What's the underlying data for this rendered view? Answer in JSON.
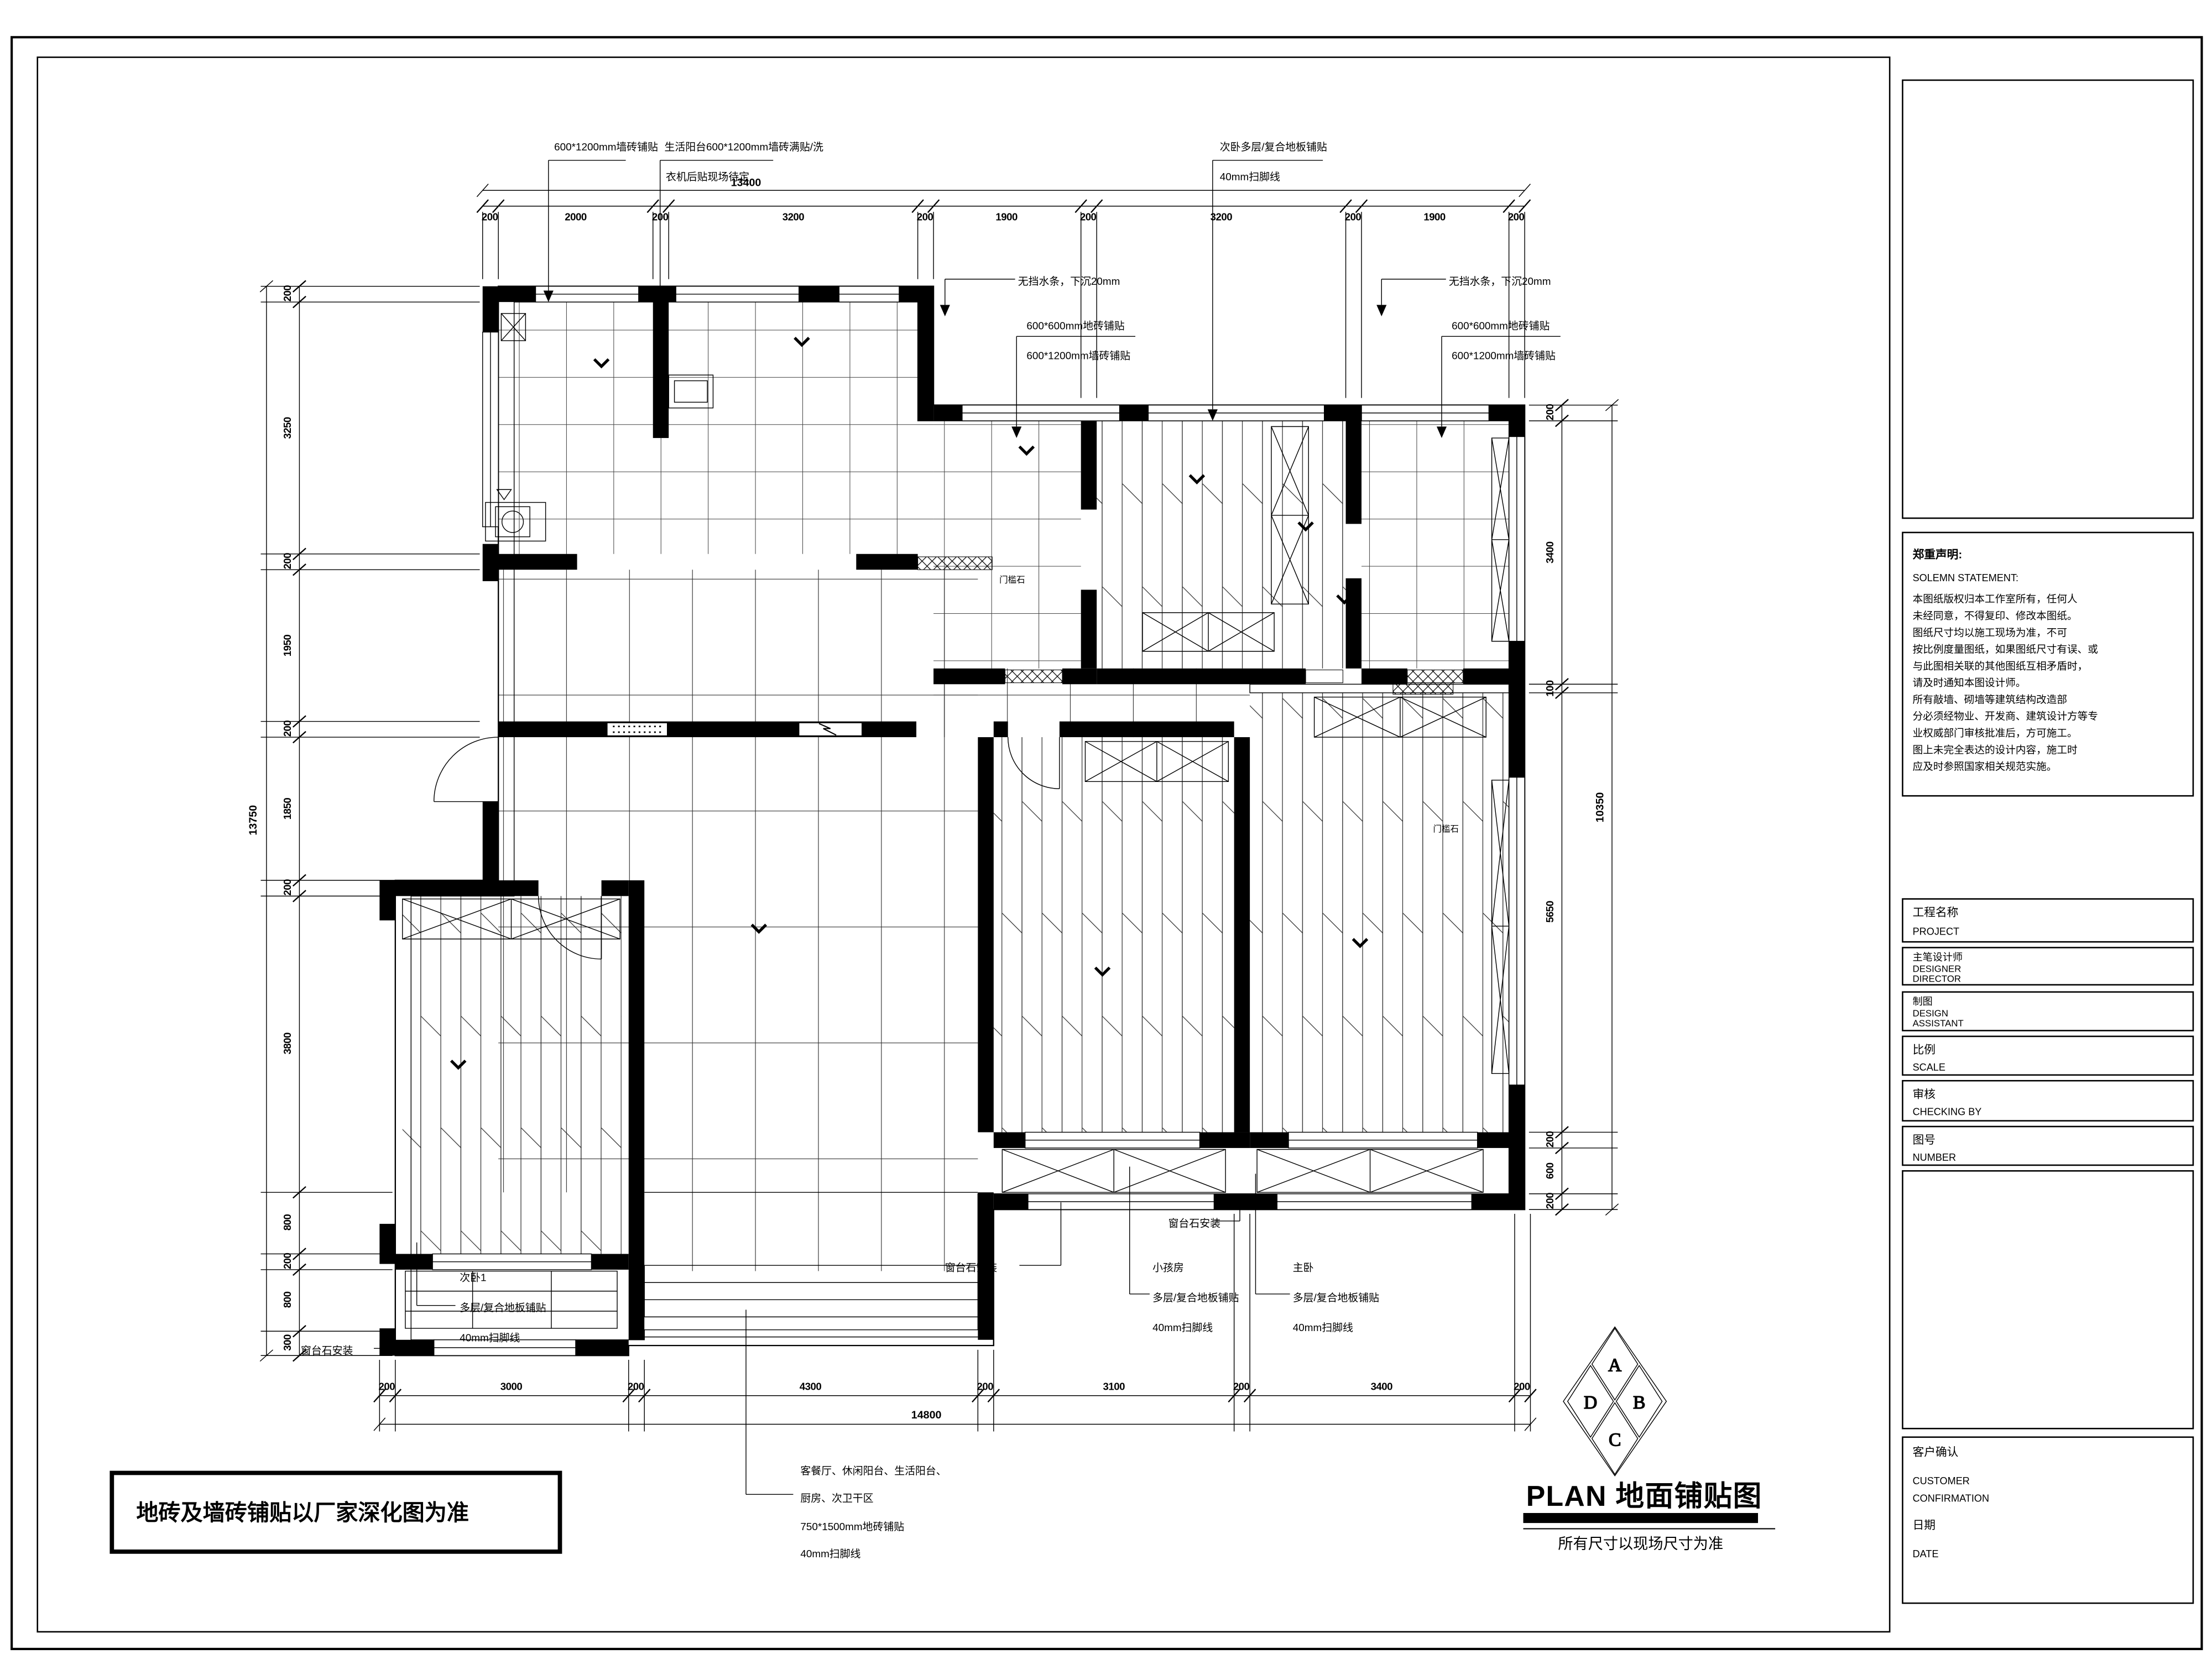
{
  "plan_title": {
    "main": "PLAN 地面铺贴图",
    "subtitle": "所有尺寸以现场尺寸为准"
  },
  "compass": {
    "a": "A",
    "b": "B",
    "c": "C",
    "d": "D"
  },
  "statement": {
    "title_zh": "郑重声明:",
    "title_en": "SOLEMN STATEMENT:",
    "lines": [
      "    本图纸版权归本工作室所有，任何人",
      "未经同意，不得复印、修改本图纸。",
      "    图纸尺寸均以施工现场为准，不可",
      "按比例度量图纸，如果图纸尺寸有误、或",
      "与此图相关联的其他图纸互相矛盾时，",
      "请及时通知本图设计师。",
      "    所有敲墙、砌墙等建筑结构改造部",
      "分必须经物业、开发商、建筑设计方等专",
      "业权威部门审核批准后，方可施工。",
      "    图上未完全表达的设计内容，施工时",
      "应及时参照国家相关规范实施。"
    ]
  },
  "title_block": {
    "project_zh": "工程名称",
    "project_en": "PROJECT",
    "designer_zh": "主笔设计师",
    "designer_en1": "DESIGNER",
    "designer_en2": "DIRECTOR",
    "draft_zh": "制图",
    "draft_en1": "DESIGN",
    "draft_en2": "ASSISTANT",
    "scale_zh": "比例",
    "scale_en": "SCALE",
    "check_zh": "审核",
    "check_en": "CHECKING BY",
    "number_zh": "图号",
    "number_en": "NUMBER",
    "customer_zh": "客户确认",
    "customer_en1": "CUSTOMER",
    "customer_en2": "CONFIRMATION",
    "date_zh": "日期",
    "date_en": "DATE"
  },
  "notes": {
    "factory": "地砖及墙砖铺贴以厂家深化图为准",
    "living": [
      "客餐厅、休闲阳台、生活阳台、",
      "厨房、次卫干区",
      "750*1500mm地砖铺贴",
      "40mm扫脚线"
    ]
  },
  "annotations": {
    "top_wall_tile": "600*1200mm墙砖铺贴",
    "balcony_line1": "生活阳台600*1200mm墙砖满贴/洗",
    "balcony_line2": "衣机后贴现场待定",
    "bedroom_top_line1": "次卧多层/复合地板铺贴",
    "skirting": "40mm扫脚线",
    "no_water_bar": "无挡水条，下沉20mm",
    "floor_tile_600": "600*600mm地砖铺贴",
    "wall_tile_6001200": "600*1200mm墙砖铺贴",
    "sill_install": "窗台石安装",
    "threshold_stone": "门槛石",
    "laminate": "多层/复合地板铺贴"
  },
  "rooms": {
    "bedroom2": "次卧1",
    "kids": "小孩房",
    "master": "主卧"
  },
  "dims": {
    "top": {
      "total": "13400",
      "segments": [
        "200",
        "2000",
        "200",
        "3200",
        "200",
        "1900",
        "200",
        "3200",
        "200",
        "1900",
        "200"
      ]
    },
    "bottom": {
      "total": "14800",
      "segments": [
        "200",
        "3000",
        "200",
        "4300",
        "200",
        "3100",
        "200",
        "3400",
        "200"
      ]
    },
    "left": {
      "total": "13750",
      "segments": [
        "200",
        "3250",
        "200",
        "1950",
        "200",
        "1850",
        "200",
        "3800",
        "800",
        "200",
        "800",
        "300"
      ]
    },
    "right": {
      "total": "10350",
      "segments": [
        "200",
        "3400",
        "100",
        "5650",
        "200",
        "600",
        "200"
      ]
    }
  }
}
